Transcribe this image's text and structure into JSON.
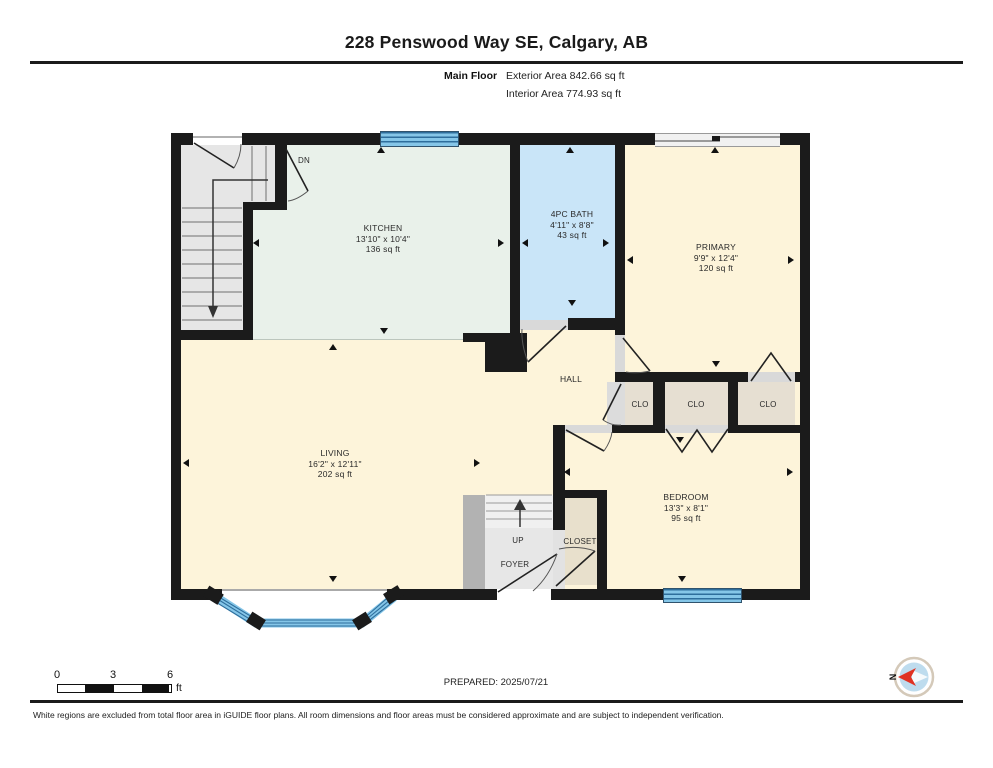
{
  "header": {
    "title": "228 Penswood Way SE, Calgary, AB",
    "floor_label": "Main Floor",
    "exterior_area": "Exterior Area 842.66 sq ft",
    "interior_area": "Interior Area 774.93 sq ft"
  },
  "rooms": {
    "kitchen": {
      "name": "KITCHEN",
      "dims": "13'10\" x 10'4\"",
      "area": "136 sq ft"
    },
    "bath": {
      "name": "4PC BATH",
      "dims": "4'11\" x 8'8\"",
      "area": "43 sq ft"
    },
    "primary": {
      "name": "PRIMARY",
      "dims": "9'9\" x 12'4\"",
      "area": "120 sq ft"
    },
    "living": {
      "name": "LIVING",
      "dims": "16'2\" x 12'11\"",
      "area": "202 sq ft"
    },
    "bedroom": {
      "name": "BEDROOM",
      "dims": "13'3\" x 8'1\"",
      "area": "95 sq ft"
    },
    "hall": {
      "name": "HALL"
    },
    "foyer": {
      "name": "FOYER"
    }
  },
  "labels": {
    "up": "UP",
    "dn": "DN",
    "closet": "CLOSET",
    "clo": "CLO",
    "compass_north": "N"
  },
  "footer": {
    "prepared": "PREPARED: 2025/07/21",
    "scale_ticks": [
      "0",
      "3",
      "6"
    ],
    "scale_unit": "ft",
    "disclaimer": "White regions are excluded from total floor area in iGUIDE floor plans. All room dimensions and floor areas must be considered approximate and are subject to independent verification."
  },
  "colors": {
    "wall": "#1b1b1b",
    "kitchen_mint": "#e9f1ea",
    "bath_blue": "#c9e5f8",
    "room_cream": "#fdf4da",
    "closet_beige": "#e6dfd2",
    "stair_gray": "#e6e6e6",
    "window_blue": "#85c6e8",
    "compass_red": "#e03222"
  }
}
